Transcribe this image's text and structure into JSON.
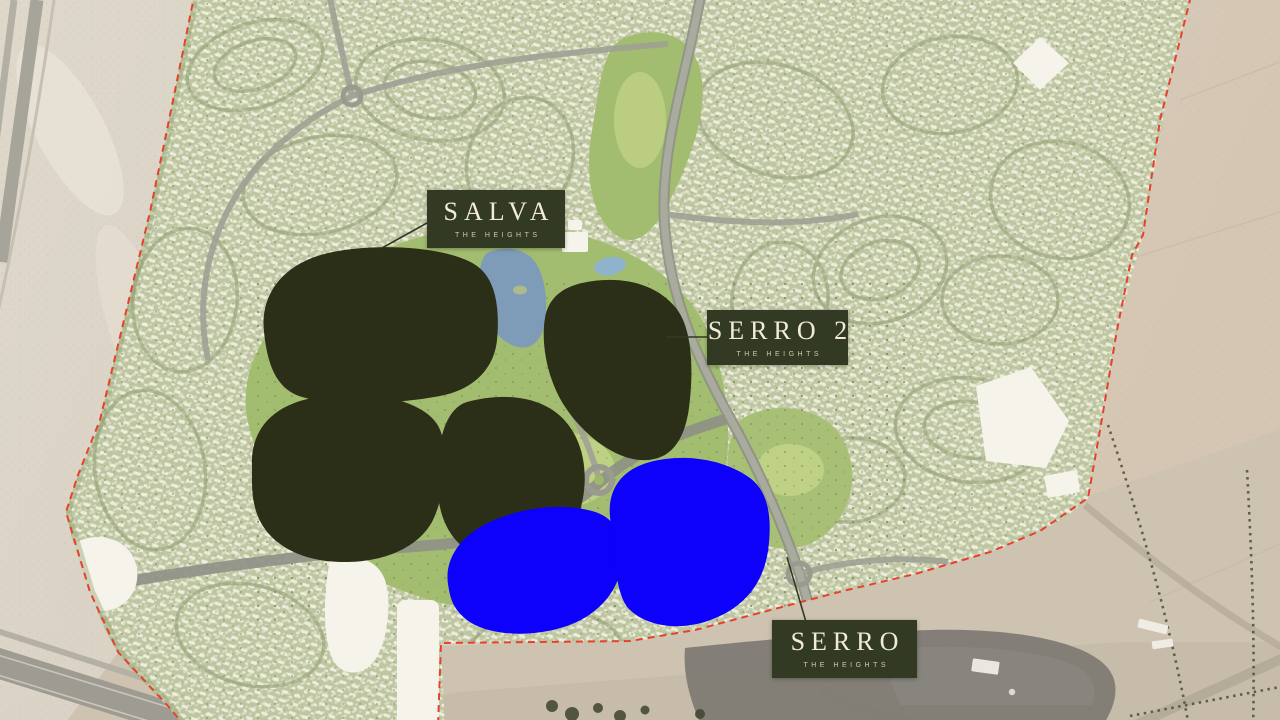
{
  "map": {
    "kind": "masterplan-aerial-map",
    "labels": {
      "salva": {
        "title": "SALVA",
        "subtitle": "THE HEIGHTS"
      },
      "serro2": {
        "title": "SERRO 2",
        "subtitle": "THE HEIGHTS"
      },
      "serro": {
        "title": "SERRO",
        "subtitle": "THE HEIGHTS"
      }
    },
    "highlights": [
      {
        "id": "salva-zone",
        "label": "SALVA",
        "color": "#2b2f17"
      },
      {
        "id": "serro2-zone",
        "label": "SERRO 2",
        "color": "#2b2f17"
      },
      {
        "id": "serro-zone",
        "label": "SERRO",
        "color": "#0d00fb"
      }
    ],
    "colors": {
      "label_bg": "#333a23",
      "label_text": "#f1ebd8",
      "label_subtext": "#cfc9b0",
      "highlight_dark": "#2b2f17",
      "highlight_blue": "#0d00fb",
      "boundary_red": "#e8402e",
      "desert_sand": "#dad2c4",
      "development_green": "#bec6a1",
      "golf_green": "#a3bd70",
      "water_blue": "#7e9cb8"
    }
  }
}
